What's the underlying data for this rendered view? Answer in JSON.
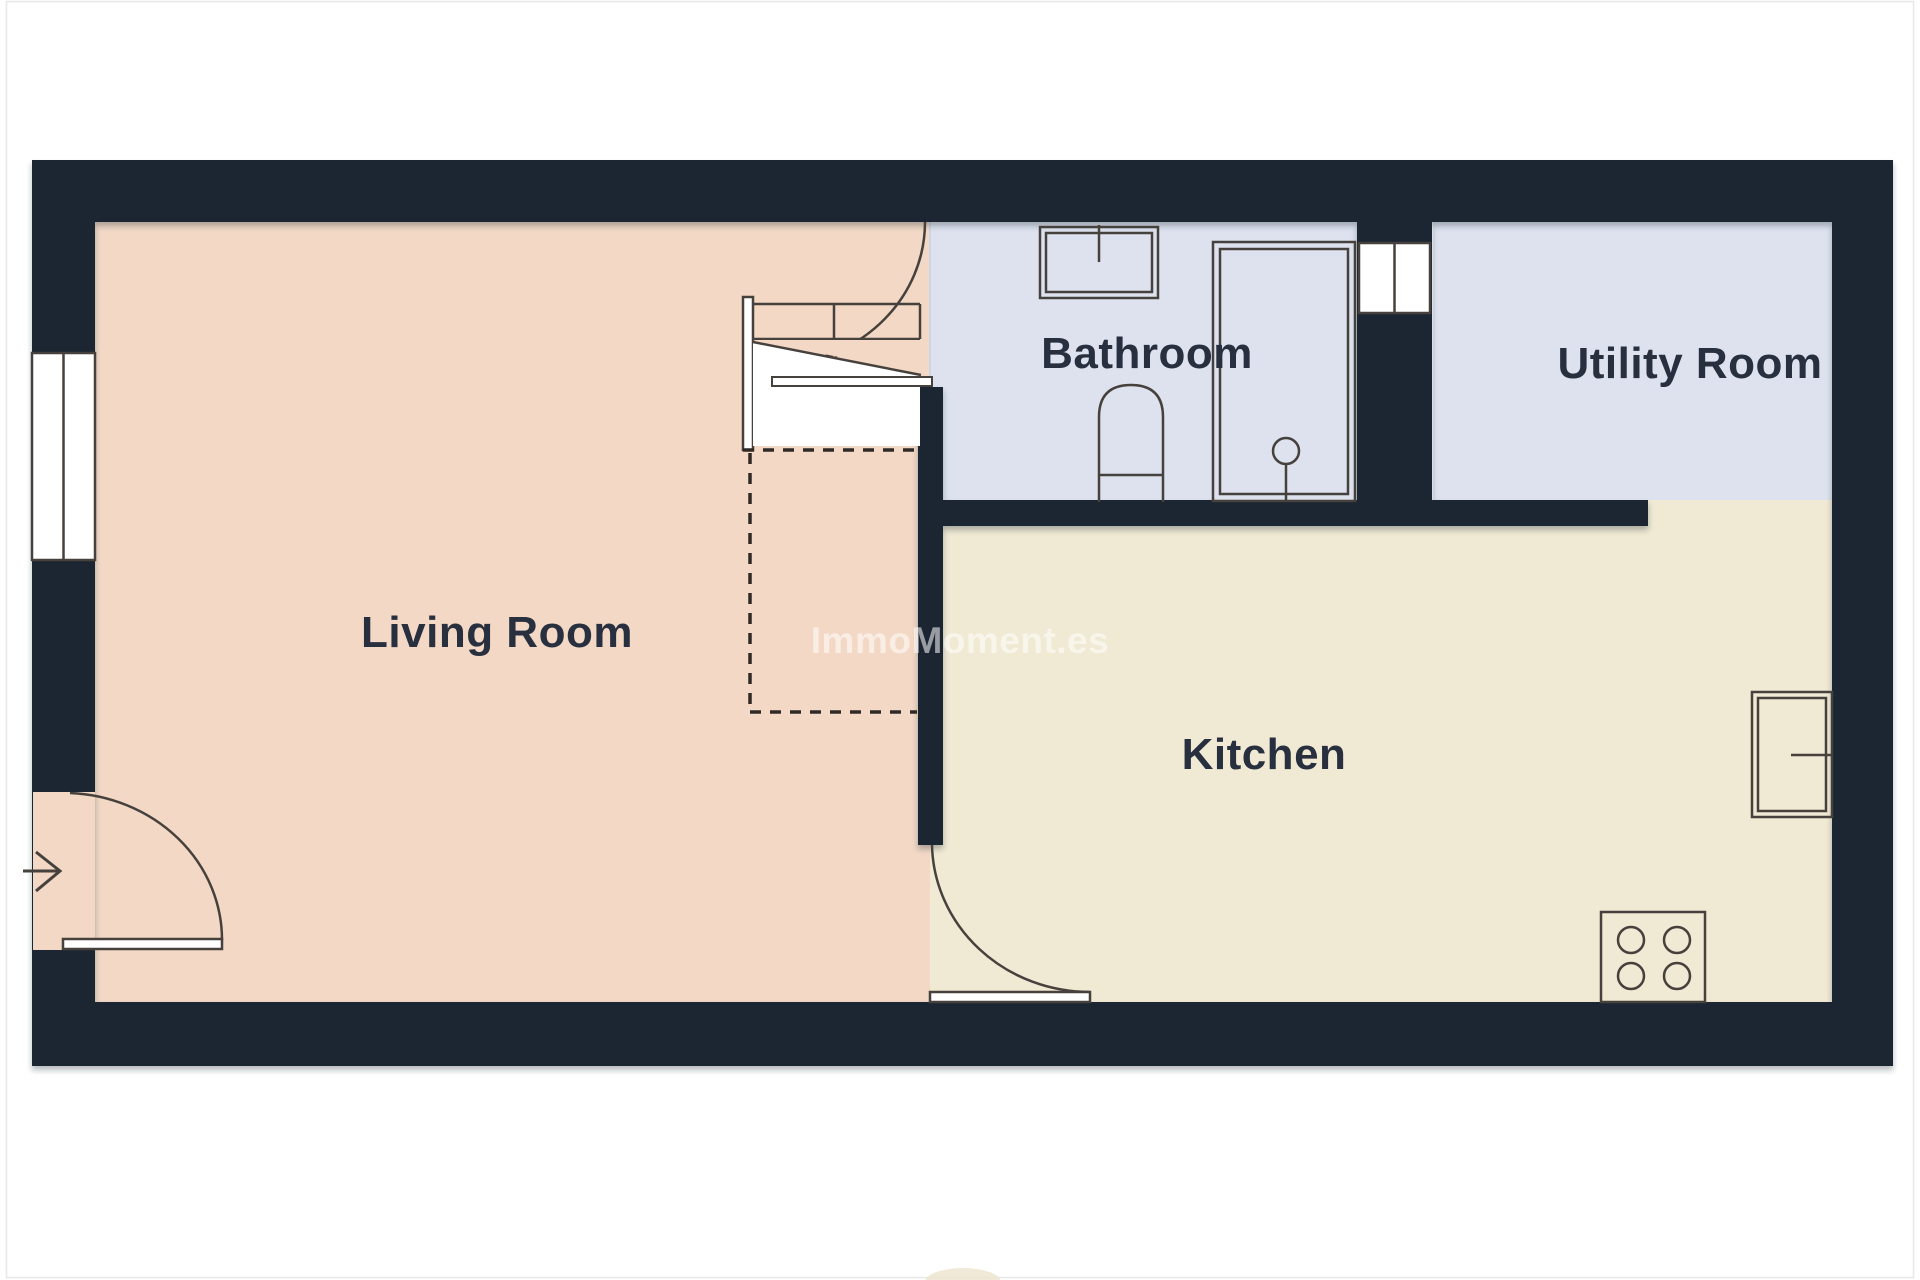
{
  "plan": {
    "type": "floor-plan",
    "watermark": {
      "text": "ImmoMoment.es",
      "color": "#ffffff",
      "opacity": 0.55
    }
  },
  "rooms": {
    "living": {
      "label": "Living Room",
      "floor_color": "#f2d8c5"
    },
    "bathroom": {
      "label": "Bathroom",
      "floor_color": "#dde2ee"
    },
    "utility": {
      "label": "Utility Room",
      "floor_color": "#dde2ee"
    },
    "kitchen": {
      "label": "Kitchen",
      "floor_color": "#f0e9d3"
    }
  },
  "colors": {
    "wall": "#1e2633",
    "line": "#46413c",
    "dash_line": "#2f2a26",
    "label_text": "#28303f",
    "opening_fill": "#ffffff",
    "boundary_line": "#cfd4e2",
    "frame_border": "#e8e8e8",
    "artifact": "#ece3cd"
  },
  "fixtures": [
    "staircase-with-direction-arrow",
    "under-stairs-dashed-area",
    "stairs-door-swing-arc",
    "left-wall-window",
    "entry-door-with-swing-arc",
    "entry-direction-arrow",
    "bathroom-sink",
    "shower-enclosure-with-drain",
    "toilet",
    "utility-room-door",
    "kitchen-door-with-swing-arc",
    "stove-four-burners",
    "kitchen-wall-appliance"
  ]
}
